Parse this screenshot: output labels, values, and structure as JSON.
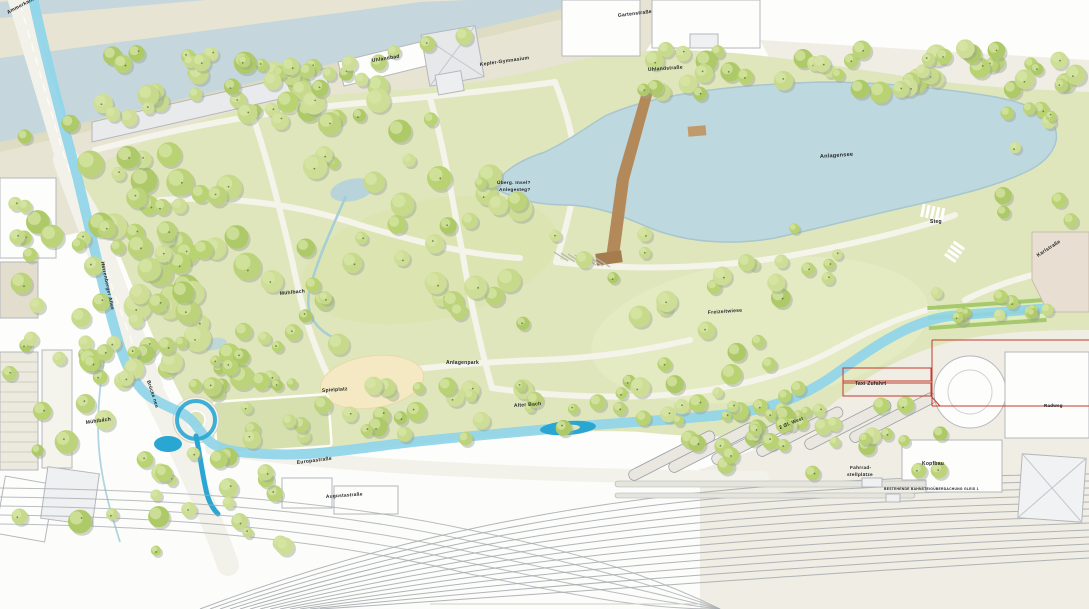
{
  "colors": {
    "stream_blue": "#2aa6d2",
    "stream_edge": "#8ed4ea",
    "river": "#c5d7dc",
    "lake": "#bed8df",
    "park_green": "#e0e6bc",
    "meadow_green": "#e4eac2",
    "ground_tan": "#e8e4d3",
    "road_white": "#f3f2ea",
    "building_white": "#fdfdfc",
    "building_stroke": "#b4b7bb",
    "rail_gray": "#a7acb0",
    "boundary_red": "#c23b2e",
    "bridge_brown": "#b4895a",
    "playground_sand": "#f4e9c3",
    "label_dark": "#22262a",
    "tree_greens": [
      "#bcd37b",
      "#c7da8c",
      "#aeca68",
      "#b9d272",
      "#cede96"
    ],
    "tree_shadow": "#9aa492"
  },
  "labels": [
    {
      "id": "ammerkanal",
      "text": "Ammerkanal",
      "x": 8,
      "y": 14,
      "rot": -28,
      "fs": 5
    },
    {
      "id": "uhlandbad",
      "text": "Uhlandbad",
      "x": 372,
      "y": 62,
      "rot": -9,
      "fs": 5
    },
    {
      "id": "kepler-gymnasium",
      "text": "Kepler-Gymnasium",
      "x": 480,
      "y": 66,
      "rot": -8,
      "fs": 5
    },
    {
      "id": "gartenstrasse",
      "text": "Gartenstraße",
      "x": 618,
      "y": 17,
      "rot": -7,
      "fs": 5
    },
    {
      "id": "uhlandstrasse",
      "text": "Uhlandstraße",
      "x": 648,
      "y": 71,
      "rot": -4,
      "fs": 5
    },
    {
      "id": "anlagensee",
      "text": "Anlagensee",
      "x": 820,
      "y": 158,
      "rot": -4,
      "fs": 5.5
    },
    {
      "id": "annotation-uebergang",
      "text": "Überg. Insel?",
      "x": 497,
      "y": 184,
      "rot": 0,
      "fs": 4.8
    },
    {
      "id": "annotation-anlegesteg",
      "text": "Anlegesteg?",
      "x": 499,
      "y": 191,
      "rot": 0,
      "fs": 4.8
    },
    {
      "id": "steg",
      "text": "Steg",
      "x": 930,
      "y": 223,
      "rot": 0,
      "fs": 5
    },
    {
      "id": "karlstrasse",
      "text": "Karlstraße",
      "x": 1038,
      "y": 257,
      "rot": -33,
      "fs": 5
    },
    {
      "id": "muehlbach-park",
      "text": "Mühlbach",
      "x": 280,
      "y": 295,
      "rot": -6,
      "fs": 5
    },
    {
      "id": "freizeitwiese",
      "text": "Freizeitwiese",
      "x": 708,
      "y": 314,
      "rot": -4,
      "fs": 5
    },
    {
      "id": "anlagenpark",
      "text": "Anlagenpark",
      "x": 446,
      "y": 364,
      "rot": 0,
      "fs": 5
    },
    {
      "id": "spielplatz",
      "text": "Spielplatz",
      "x": 322,
      "y": 392,
      "rot": -4,
      "fs": 5
    },
    {
      "id": "alter-bach",
      "text": "Alter Bach",
      "x": 514,
      "y": 407,
      "rot": -4,
      "fs": 5
    },
    {
      "id": "herrenberger-allee",
      "text": "Herrenberger Allee",
      "x": 101,
      "y": 262,
      "rot": 78,
      "fs": 5
    },
    {
      "id": "bruecke-neu",
      "text": "Brücke neu",
      "x": 147,
      "y": 381,
      "rot": 72,
      "fs": 4.8
    },
    {
      "id": "muehlbach-west",
      "text": "Mühlbach",
      "x": 86,
      "y": 424,
      "rot": -8,
      "fs": 5
    },
    {
      "id": "europastrasse",
      "text": "Europastraße",
      "x": 297,
      "y": 464,
      "rot": -7,
      "fs": 5
    },
    {
      "id": "augustastrasse",
      "text": "Augustastraße",
      "x": 326,
      "y": 498,
      "rot": -4,
      "fs": 4.8
    },
    {
      "id": "taxi-zufahrt",
      "text": "Taxi Zufahrt",
      "x": 855,
      "y": 385,
      "rot": 0,
      "fs": 5
    },
    {
      "id": "gleise-west",
      "text": "2 Gl. West",
      "x": 780,
      "y": 429,
      "rot": -22,
      "fs": 4.8
    },
    {
      "id": "fahrrad-line1",
      "text": "Fahrrad-",
      "x": 850,
      "y": 469,
      "rot": 0,
      "fs": 4.8
    },
    {
      "id": "fahrrad-line2",
      "text": "stellplätze",
      "x": 847,
      "y": 476,
      "rot": 0,
      "fs": 4.8
    },
    {
      "id": "kopfbau",
      "text": "Kopfbau",
      "x": 922,
      "y": 465,
      "rot": 0,
      "fs": 5
    },
    {
      "id": "radweg",
      "text": "Radweg",
      "x": 1044,
      "y": 407,
      "rot": 0,
      "fs": 4.5
    },
    {
      "id": "bahnsteig-caption",
      "text": "BESTEHENDE BAHNSTEIGÜBERDACHUNG GLEIS 1",
      "x": 884,
      "y": 490,
      "rot": 0,
      "fs": 3.4,
      "color": "#8a9096"
    }
  ]
}
